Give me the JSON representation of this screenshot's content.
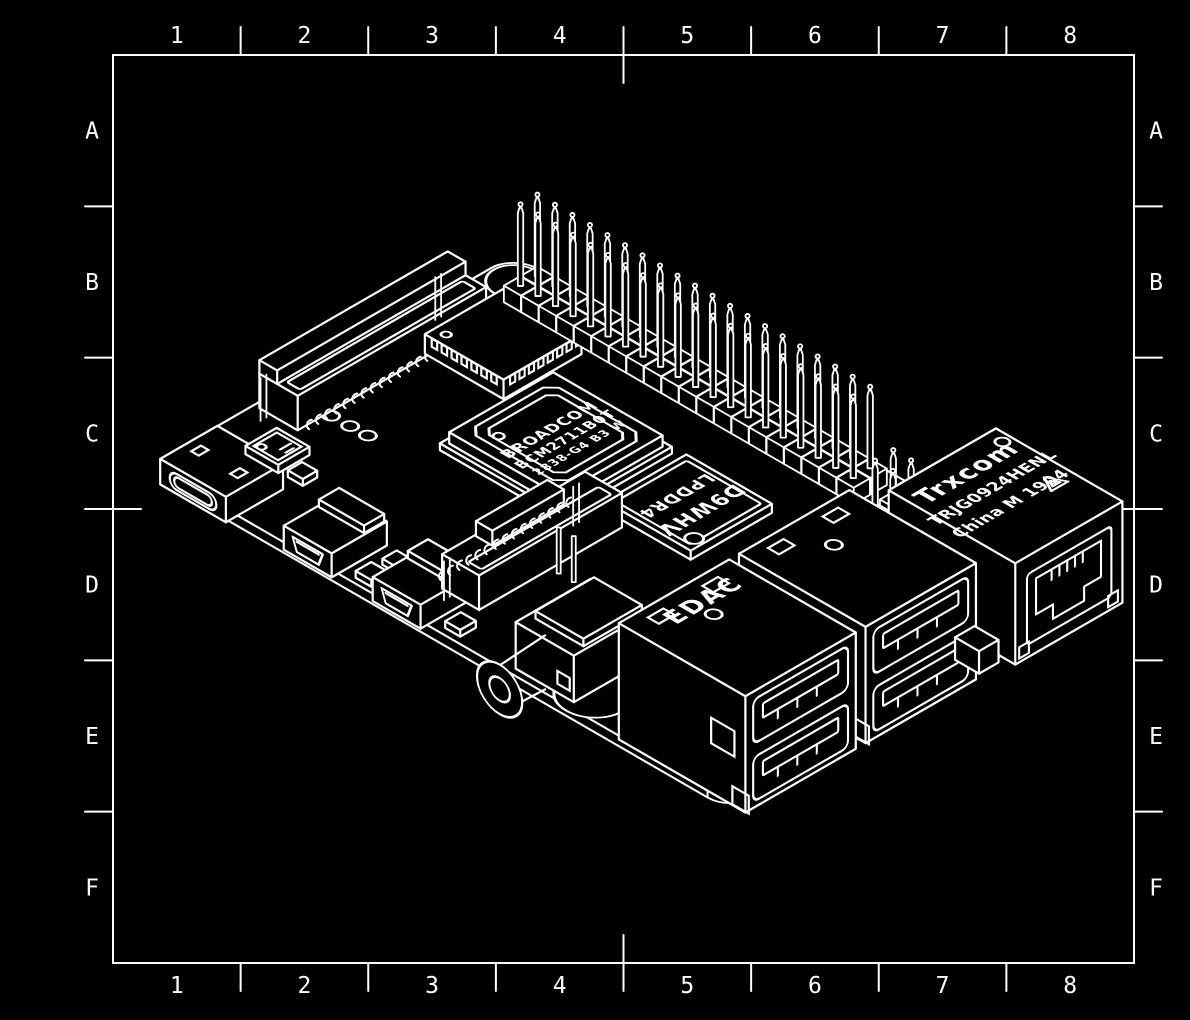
{
  "title": "Single-board computer isometric technical drawing",
  "canvas": {
    "background": "#000000",
    "ink": "#ffffff"
  },
  "frame": {
    "columns": [
      "1",
      "2",
      "3",
      "4",
      "5",
      "6",
      "7",
      "8"
    ],
    "rows": [
      "A",
      "B",
      "C",
      "D",
      "E",
      "F"
    ]
  },
  "board": {
    "name": "Raspberry Pi style single-board computer",
    "labels": {
      "soc_lines": [
        "BROADCOM",
        "BCM2711B0T",
        "2838-G4 B3 W"
      ],
      "ram_lines": [
        "D9WHV",
        "LPDDR4"
      ],
      "usb_brand": "EDAC",
      "ethernet_lines": [
        "Trxcom",
        "TRJG0924HENL",
        "China M 1904"
      ]
    },
    "components": [
      {
        "id": "pcb-board",
        "label": "PCB with rounded corners and mounting holes"
      },
      {
        "id": "dsi-connector",
        "label": "Display ribbon connector"
      },
      {
        "id": "wireless-module",
        "label": "Wireless module with castellated edges"
      },
      {
        "id": "gpio-header",
        "label": "40-pin GPIO header"
      },
      {
        "id": "poe-header",
        "label": "PoE header pins"
      },
      {
        "id": "soc-chip",
        "label": "Broadcom SoC"
      },
      {
        "id": "usb-c-power",
        "label": "USB-C power connector"
      },
      {
        "id": "pmic-chip",
        "label": "Power management IC"
      },
      {
        "id": "ram-chip",
        "label": "LPDDR4 memory"
      },
      {
        "id": "micro-hdmi-0",
        "label": "micro-HDMI port 0"
      },
      {
        "id": "micro-hdmi-1",
        "label": "micro-HDMI port 1"
      },
      {
        "id": "csi-connector",
        "label": "Camera ribbon connector"
      },
      {
        "id": "audio-jack",
        "label": "3.5 mm A/V jack"
      },
      {
        "id": "ethernet-jack",
        "label": "RJ45 Ethernet jack"
      },
      {
        "id": "usb-stack-rear",
        "label": "Dual USB stack (rear)"
      },
      {
        "id": "usb-stack-front",
        "label": "Dual USB stack (front)"
      }
    ]
  }
}
